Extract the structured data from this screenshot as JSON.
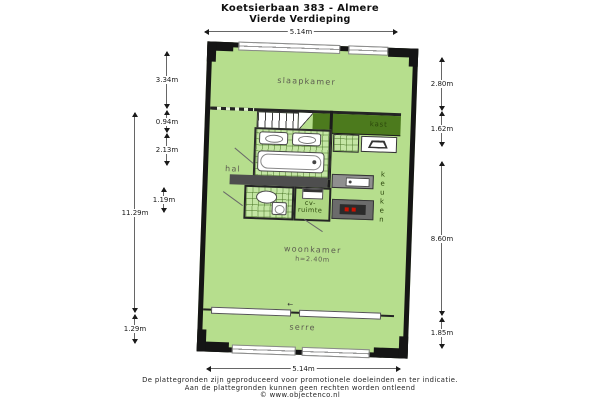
{
  "title": {
    "line1": "Koetsierbaan 383 - Almere",
    "line2": "Vierde Verdieping"
  },
  "rooms": {
    "slaapkamer": "slaapkamer",
    "hal": "hal",
    "kast": "kast",
    "keuken": "keuken",
    "cv_line1": "cv-",
    "cv_line2": "ruimte",
    "woonkamer": "woonkamer",
    "woonkamer_ceiling": "h=2.40m",
    "serre": "serre"
  },
  "dims": {
    "top": "5.14m",
    "bottom": "5.14m",
    "left_inner": [
      "3.34m",
      "0.94m",
      "2.13m",
      "1.19m"
    ],
    "left_outer": [
      "11.29m",
      "1.29m"
    ],
    "right": [
      "2.80m",
      "1.62m",
      "8.60m",
      "1.85m"
    ]
  },
  "footer": {
    "line1": "De plattegronden zijn geproduceerd voor promotionele doeleinden en ter indicatie.",
    "line2": "Aan de plattegronden kunnen geen rechten worden ontleend",
    "line3": "© www.objectenco.nl"
  },
  "colors": {
    "room_green": "#b6de8d",
    "tile_green": "#c4e6a4",
    "closet_dark_green": "#4c7a1d",
    "wall_black": "#151515",
    "interior_wall_gray": "#4e4e4e",
    "counter_gray": "#8f8f8f",
    "burner_red": "#cc1100",
    "label_gray": "#5c5c50",
    "label_olive": "#2c470c"
  }
}
